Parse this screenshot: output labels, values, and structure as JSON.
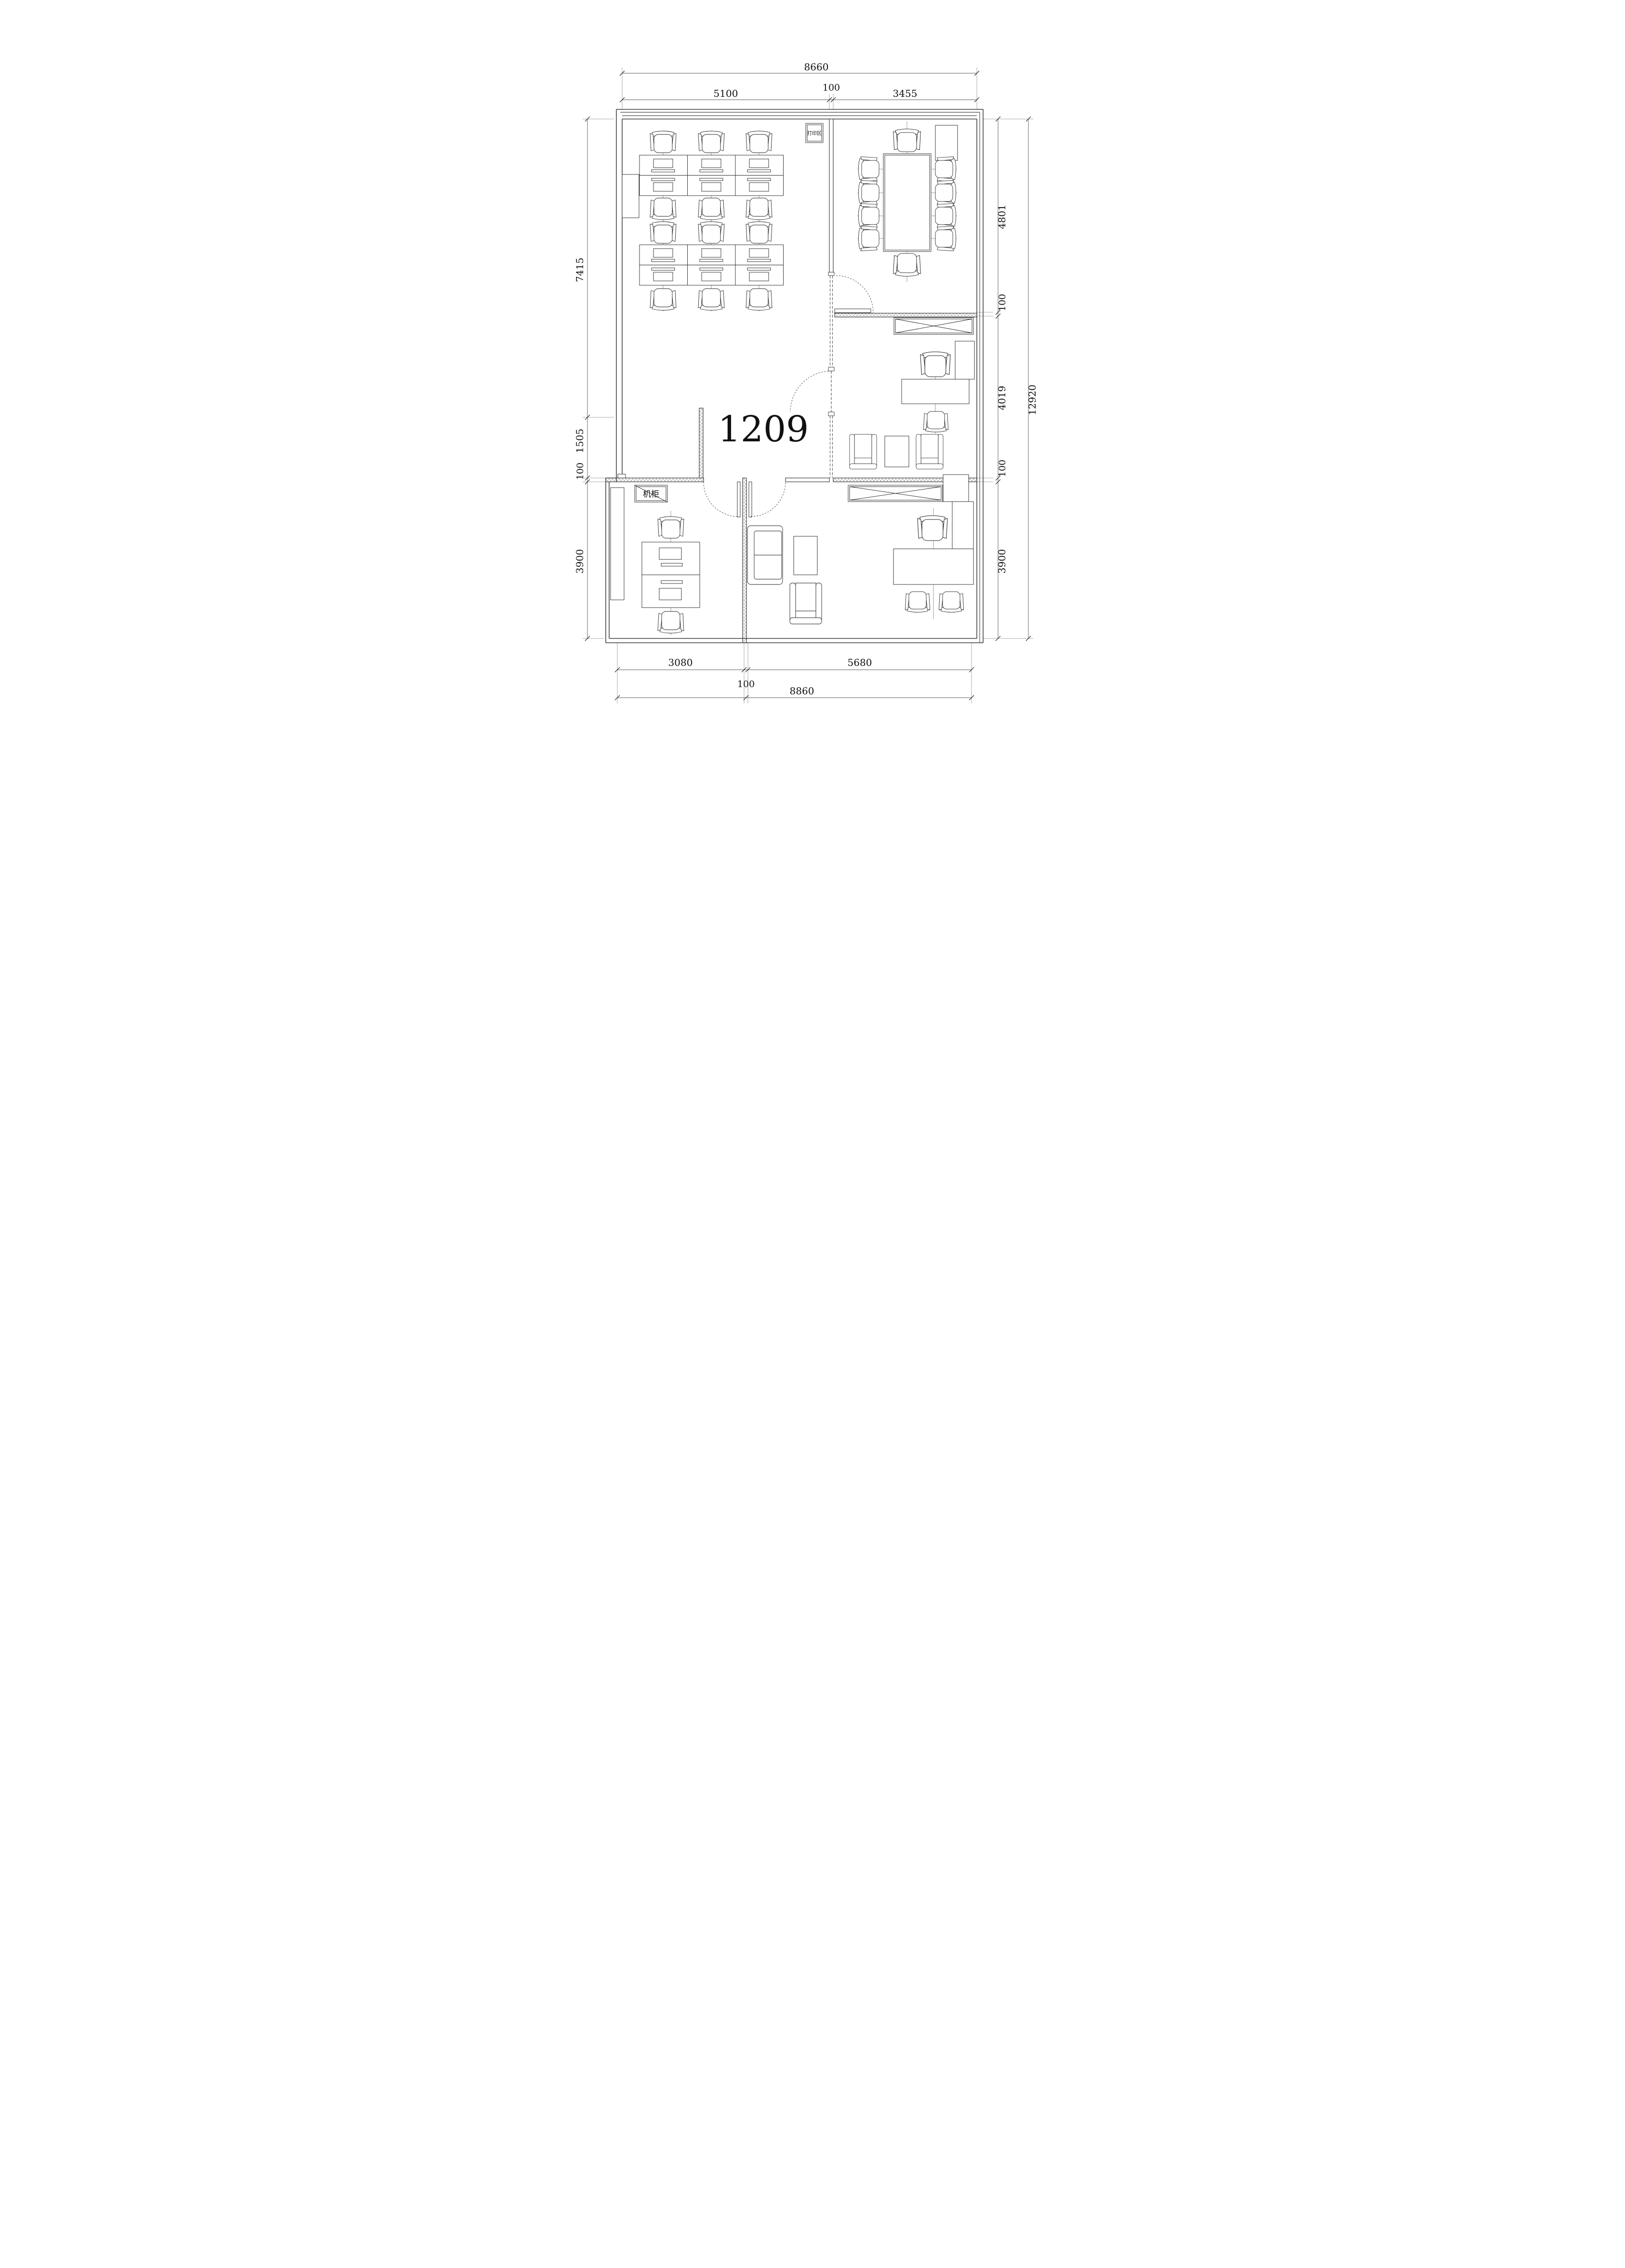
{
  "room_label": "1209",
  "annotations": {
    "print_area": "打印区",
    "server_cabinet": "机柜"
  },
  "dimensions": {
    "top": {
      "overall": "8660",
      "segments": [
        "5100",
        "100",
        "3455"
      ]
    },
    "left": {
      "segments": [
        "7415",
        "1505",
        "100",
        "3900"
      ]
    },
    "right": {
      "segments": [
        "4801",
        "100",
        "4019",
        "100",
        "3900"
      ],
      "overall": "12920"
    },
    "bottom": {
      "segments": [
        "3080",
        "100",
        "5680"
      ],
      "overall": "8860"
    }
  },
  "colors": {
    "line": "#1a1a1a",
    "background": "#ffffff"
  }
}
